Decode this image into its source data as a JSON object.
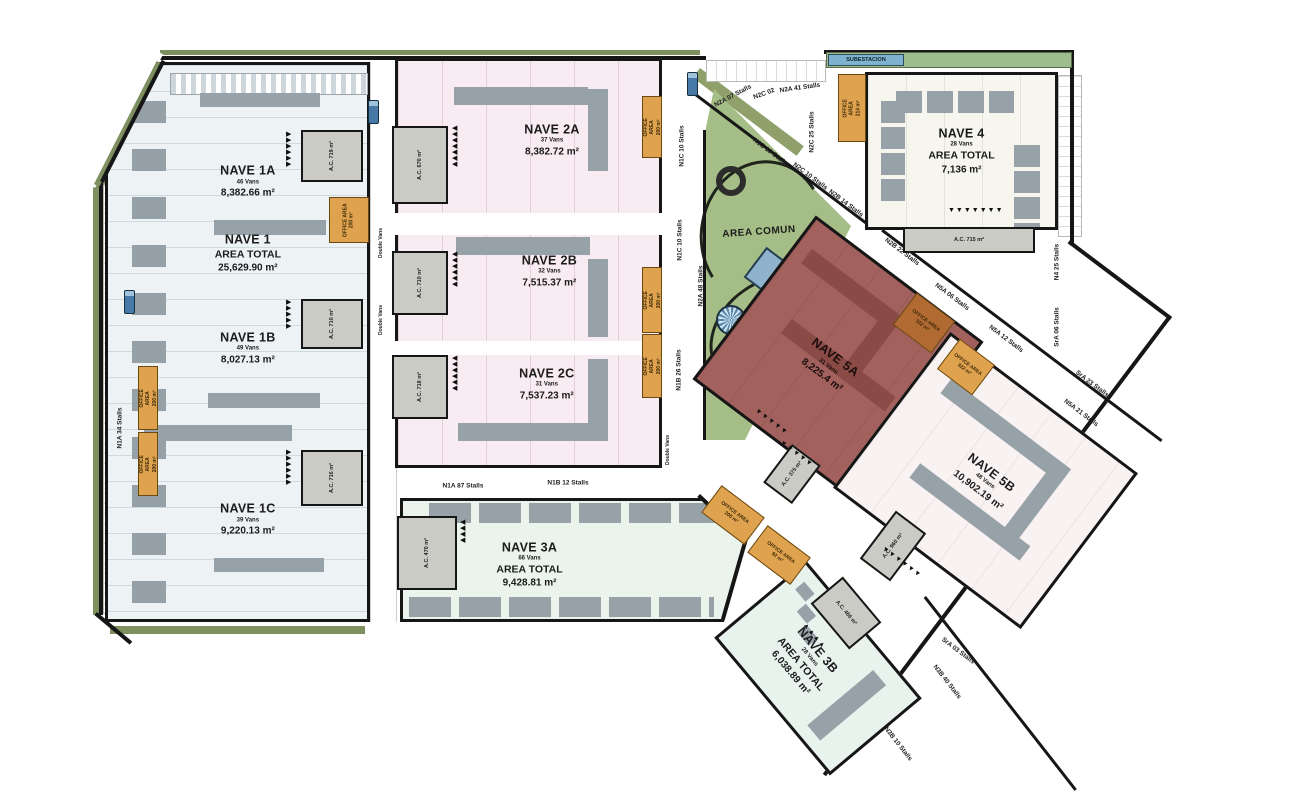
{
  "common": {
    "area_comun": "AREA COMUN",
    "subestacion": "SUBESTACION"
  },
  "buildings": {
    "nave1a": {
      "name": "NAVE 1A",
      "vans": "46 Vans",
      "area": "8,382.66 m²"
    },
    "nave1": {
      "name": "NAVE 1",
      "subtitle": "AREA TOTAL",
      "area": "25,629.90 m²"
    },
    "nave1b": {
      "name": "NAVE 1B",
      "vans": "49 Vans",
      "area": "8,027.13 m²"
    },
    "nave1c": {
      "name": "NAVE 1C",
      "vans": "39 Vans",
      "area": "9,220.13 m²"
    },
    "nave2a": {
      "name": "NAVE 2A",
      "vans": "37 Vans",
      "area": "8,382.72 m²"
    },
    "nave2b": {
      "name": "NAVE 2B",
      "vans": "32 Vans",
      "area": "7,515.37 m²"
    },
    "nave2c": {
      "name": "NAVE 2C",
      "vans": "31 Vans",
      "area": "7,537.23 m²"
    },
    "nave3a": {
      "name": "NAVE 3A",
      "vans": "66 Vans",
      "subtitle": "AREA TOTAL",
      "area": "9,428.81 m²"
    },
    "nave3b": {
      "name": "NAVE 3B",
      "vans": "28 Vans",
      "subtitle": "AREA TOTAL",
      "area": "6,038.89 m²"
    },
    "nave4": {
      "name": "NAVE 4",
      "vans": "28 Vans",
      "subtitle": "AREA TOTAL",
      "area": "7,136 m²"
    },
    "nave5a": {
      "name": "NAVE 5A",
      "vans": "31 Vans",
      "area": "8,225.4 m²"
    },
    "nave5b": {
      "name": "NAVE 5B",
      "vans": "48 Vans",
      "area": "10,902.19 m²"
    }
  },
  "stall_labels": [
    {
      "t": "N1A 34 Stalls",
      "x": 120,
      "y": 428,
      "r": -90
    },
    {
      "t": "N1A 87 Stalls",
      "x": 463,
      "y": 486,
      "r": 0
    },
    {
      "t": "N1B 12 Stalls",
      "x": 568,
      "y": 483,
      "r": 0
    },
    {
      "t": "N1C 10 Stalls",
      "x": 682,
      "y": 146,
      "r": -90
    },
    {
      "t": "N1C 10 Stalls",
      "x": 680,
      "y": 240,
      "r": -90
    },
    {
      "t": "N2A 48 Stalls",
      "x": 701,
      "y": 286,
      "r": -90
    },
    {
      "t": "N1B 26 Stalls",
      "x": 679,
      "y": 370,
      "r": -90
    },
    {
      "t": "N2A 07 Stalls",
      "x": 733,
      "y": 96,
      "r": -28
    },
    {
      "t": "N2C 02",
      "x": 764,
      "y": 94,
      "r": -20
    },
    {
      "t": "N2A 41 Stalls",
      "x": 800,
      "y": 88,
      "r": -8
    },
    {
      "t": "N2C 25 Stalls",
      "x": 812,
      "y": 132,
      "r": -90
    },
    {
      "t": "N1C 10 Stalls",
      "x": 770,
      "y": 152,
      "r": 37
    },
    {
      "t": "N2C 10 Stalls  N2B 14 Stalls",
      "x": 828,
      "y": 190,
      "r": 37
    },
    {
      "t": "N2B 22 Stalls",
      "x": 902,
      "y": 252,
      "r": 37
    },
    {
      "t": "N5A 06 Stalls",
      "x": 952,
      "y": 297,
      "r": 37
    },
    {
      "t": "N5A 12 Stalls",
      "x": 1006,
      "y": 339,
      "r": 37
    },
    {
      "t": "N4 25 Stalls",
      "x": 1057,
      "y": 262,
      "r": -90
    },
    {
      "t": "SrA 06 Stalls",
      "x": 1057,
      "y": 327,
      "r": -90
    },
    {
      "t": "SrA 23 Stalls",
      "x": 1092,
      "y": 384,
      "r": 37
    },
    {
      "t": "N5A 21 Stalls",
      "x": 1081,
      "y": 413,
      "r": 37
    },
    {
      "t": "SrA 03 Stalls",
      "x": 958,
      "y": 651,
      "r": 37
    },
    {
      "t": "N3B 40 Stalls",
      "x": 947,
      "y": 682,
      "r": 52
    },
    {
      "t": "N3B 10 Stalls",
      "x": 898,
      "y": 744,
      "r": 52
    }
  ],
  "office_boxes": [
    {
      "x": 138,
      "y": 366,
      "w": 20,
      "h": 64,
      "label": "OFFICE AREA\n200 m²",
      "vt": true
    },
    {
      "x": 138,
      "y": 432,
      "w": 20,
      "h": 64,
      "label": "OFFICE AREA\n200 m²",
      "vt": true
    },
    {
      "x": 329,
      "y": 197,
      "w": 40,
      "h": 46,
      "label": "OFFICE AREA\n200 m²",
      "vt": true
    },
    {
      "x": 642,
      "y": 96,
      "w": 20,
      "h": 62,
      "label": "OFFICE AREA\n200 m²",
      "vt": true
    },
    {
      "x": 642,
      "y": 267,
      "w": 20,
      "h": 66,
      "label": "OFFICE AREA\n200 m²",
      "vt": true
    },
    {
      "x": 642,
      "y": 334,
      "w": 20,
      "h": 64,
      "label": "OFFICE AREA\n200 m²",
      "vt": true
    },
    {
      "x": 838,
      "y": 74,
      "w": 28,
      "h": 68,
      "label": "OFFICE AREA\n214 m²",
      "vt": true
    },
    {
      "x": 900,
      "y": 303,
      "w": 48,
      "h": 40,
      "label": "OFFICE AREA\n322 m²",
      "r": 37,
      "dark": true
    },
    {
      "x": 944,
      "y": 348,
      "w": 44,
      "h": 38,
      "label": "OFFICE AREA\n322 m²",
      "r": 37
    },
    {
      "x": 706,
      "y": 498,
      "w": 54,
      "h": 34,
      "label": "OFFICE AREA\n200 m²",
      "r": 37
    },
    {
      "x": 752,
      "y": 538,
      "w": 54,
      "h": 34,
      "label": "OFFICE AREA\n92 m²",
      "r": 37
    }
  ],
  "ac_boxes": [
    {
      "x": 301,
      "y": 130,
      "w": 62,
      "h": 52,
      "label": "A.C. 719 m²",
      "vt": true
    },
    {
      "x": 301,
      "y": 299,
      "w": 62,
      "h": 50,
      "label": "A.C. 710 m²",
      "vt": true
    },
    {
      "x": 301,
      "y": 450,
      "w": 62,
      "h": 56,
      "label": "A.C. 716 m²",
      "vt": true
    },
    {
      "x": 392,
      "y": 126,
      "w": 56,
      "h": 78,
      "label": "A.C. 670 m²",
      "vt": true
    },
    {
      "x": 392,
      "y": 251,
      "w": 56,
      "h": 64,
      "label": "A.C. 710 m²",
      "vt": true
    },
    {
      "x": 392,
      "y": 355,
      "w": 56,
      "h": 64,
      "label": "A.C. 718 m²",
      "vt": true
    },
    {
      "x": 397,
      "y": 516,
      "w": 60,
      "h": 74,
      "label": "A.C. 470 m²",
      "vt": true
    },
    {
      "x": 903,
      "y": 227,
      "w": 132,
      "h": 26,
      "label": "A.C. 715 m²"
    },
    {
      "x": 874,
      "y": 516,
      "w": 38,
      "h": 60,
      "label": "A.C. 960 m²",
      "r": 37,
      "vt": true
    },
    {
      "x": 774,
      "y": 450,
      "w": 36,
      "h": 48,
      "label": "A.C. 375 m²",
      "r": 37,
      "vt": true
    },
    {
      "x": 816,
      "y": 592,
      "w": 60,
      "h": 42,
      "label": "A.C. 466 m²",
      "r": 50
    }
  ],
  "arrow_groups": [
    {
      "g": "▶",
      "n": 6,
      "x": 286,
      "y": 132,
      "vertical": true
    },
    {
      "g": "▶",
      "n": 5,
      "x": 286,
      "y": 300,
      "vertical": true
    },
    {
      "g": "▶",
      "n": 6,
      "x": 286,
      "y": 450,
      "vertical": true
    },
    {
      "g": "◀",
      "n": 7,
      "x": 452,
      "y": 126,
      "vertical": true
    },
    {
      "g": "◀",
      "n": 6,
      "x": 452,
      "y": 252,
      "vertical": true
    },
    {
      "g": "◀",
      "n": 6,
      "x": 452,
      "y": 356,
      "vertical": true
    },
    {
      "g": "◀",
      "n": 4,
      "x": 460,
      "y": 520,
      "vertical": true
    },
    {
      "g": "▼",
      "n": 7,
      "x": 948,
      "y": 208,
      "vertical": false
    },
    {
      "g": "▼",
      "n": 5,
      "x": 757,
      "y": 408,
      "vertical": false,
      "r": 37
    },
    {
      "g": "▼",
      "n": 5,
      "x": 782,
      "y": 440,
      "vertical": false,
      "r": 37
    },
    {
      "g": "▼",
      "n": 6,
      "x": 884,
      "y": 546,
      "vertical": false,
      "r": 37
    },
    {
      "g": "▲",
      "n": 4,
      "x": 806,
      "y": 622,
      "vertical": false,
      "r": 50
    }
  ],
  "small_labels": [
    {
      "t": "Double Vans",
      "x": 381,
      "y": 243,
      "r": -90
    },
    {
      "t": "Double Vans",
      "x": 381,
      "y": 320,
      "r": -90
    },
    {
      "t": "Double Vans",
      "x": 668,
      "y": 450,
      "r": -90
    }
  ],
  "trucks": [
    {
      "x": 368,
      "y": 100
    },
    {
      "x": 687,
      "y": 72
    },
    {
      "x": 124,
      "y": 290
    }
  ],
  "colors": {
    "nave1_fill": "#edf3f5",
    "nave2_fill": "#f8ebf1",
    "nave3_fill": "#ebf4ec",
    "nave4_fill": "#f6f5ee",
    "nave5a_fill": "#a2615d",
    "nave5b_fill": "#f9f2f2",
    "area_comun_fill": "#a5bd86",
    "office_orange": "#dfa24e",
    "subestacion_blue": "#7fb2cf",
    "dock_gray": "#97a1a8"
  }
}
